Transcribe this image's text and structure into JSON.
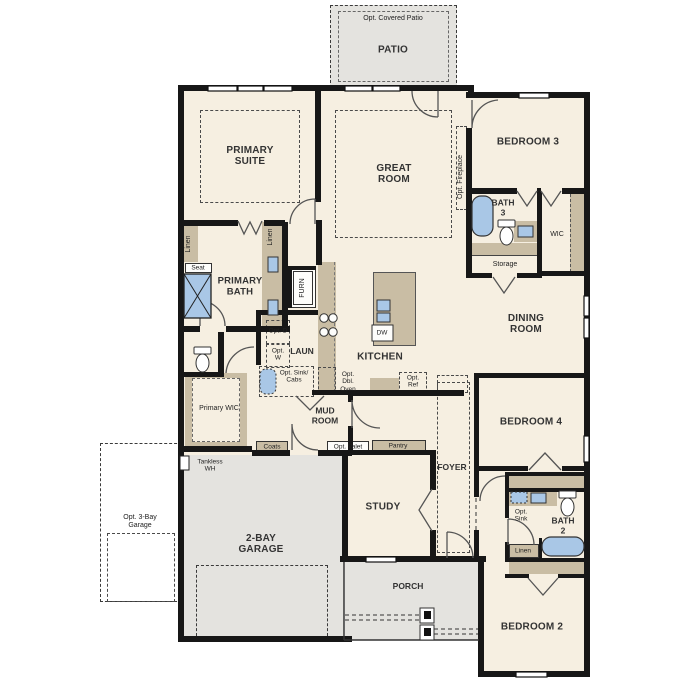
{
  "plan_title": "single-story floor plan",
  "palette": {
    "floor": "#f6efe1",
    "exterior_concrete": "#e4e3df",
    "casework_tan": "#c9bda4",
    "fixture_blue": "#a9c7e6",
    "wall": "#171717"
  },
  "labels": {
    "opt_covered_patio": "Opt. Covered Patio",
    "patio": "PATIO",
    "primary_suite": "PRIMARY SUITE",
    "great_room": "GREAT ROOM",
    "opt_fireplace": "Opt. Fireplace",
    "bedroom3": "BEDROOM 3",
    "bath3": "BATH 3",
    "wic": "WIC",
    "storage": "Storage",
    "linen_primary": "Linen",
    "linen_hall": "Linen",
    "seat": "Seat",
    "primary_bath": "PRIMARY BATH",
    "furn": "FURN",
    "opt_d": "Opt. D",
    "opt_w": "Opt. W",
    "laun": "LAUN",
    "opt_sink_cabs": "Opt. Sink/ Cabs",
    "kitchen": "KITCHEN",
    "dw": "DW",
    "opt_dbl_oven": "Opt. Dbl. Oven",
    "opt_ref": "Opt. Ref",
    "dining_room": "DINING ROOM",
    "mud_room": "MUD ROOM",
    "coats": "Coats",
    "opt_valet": "Opt. Valet",
    "pantry": "Pantry",
    "primary_wic": "Primary WIC",
    "tankless_wh": "Tankless WH",
    "opt_3bay_garage": "Opt. 3-Bay Garage",
    "garage_2bay": "2-BAY GARAGE",
    "study": "STUDY",
    "foyer": "FOYER",
    "porch": "PORCH",
    "bedroom4": "BEDROOM 4",
    "opt_sink": "Opt. Sink",
    "bath2": "BATH 2",
    "linen_bath2": "Linen",
    "bedroom2": "BEDROOM 2"
  }
}
